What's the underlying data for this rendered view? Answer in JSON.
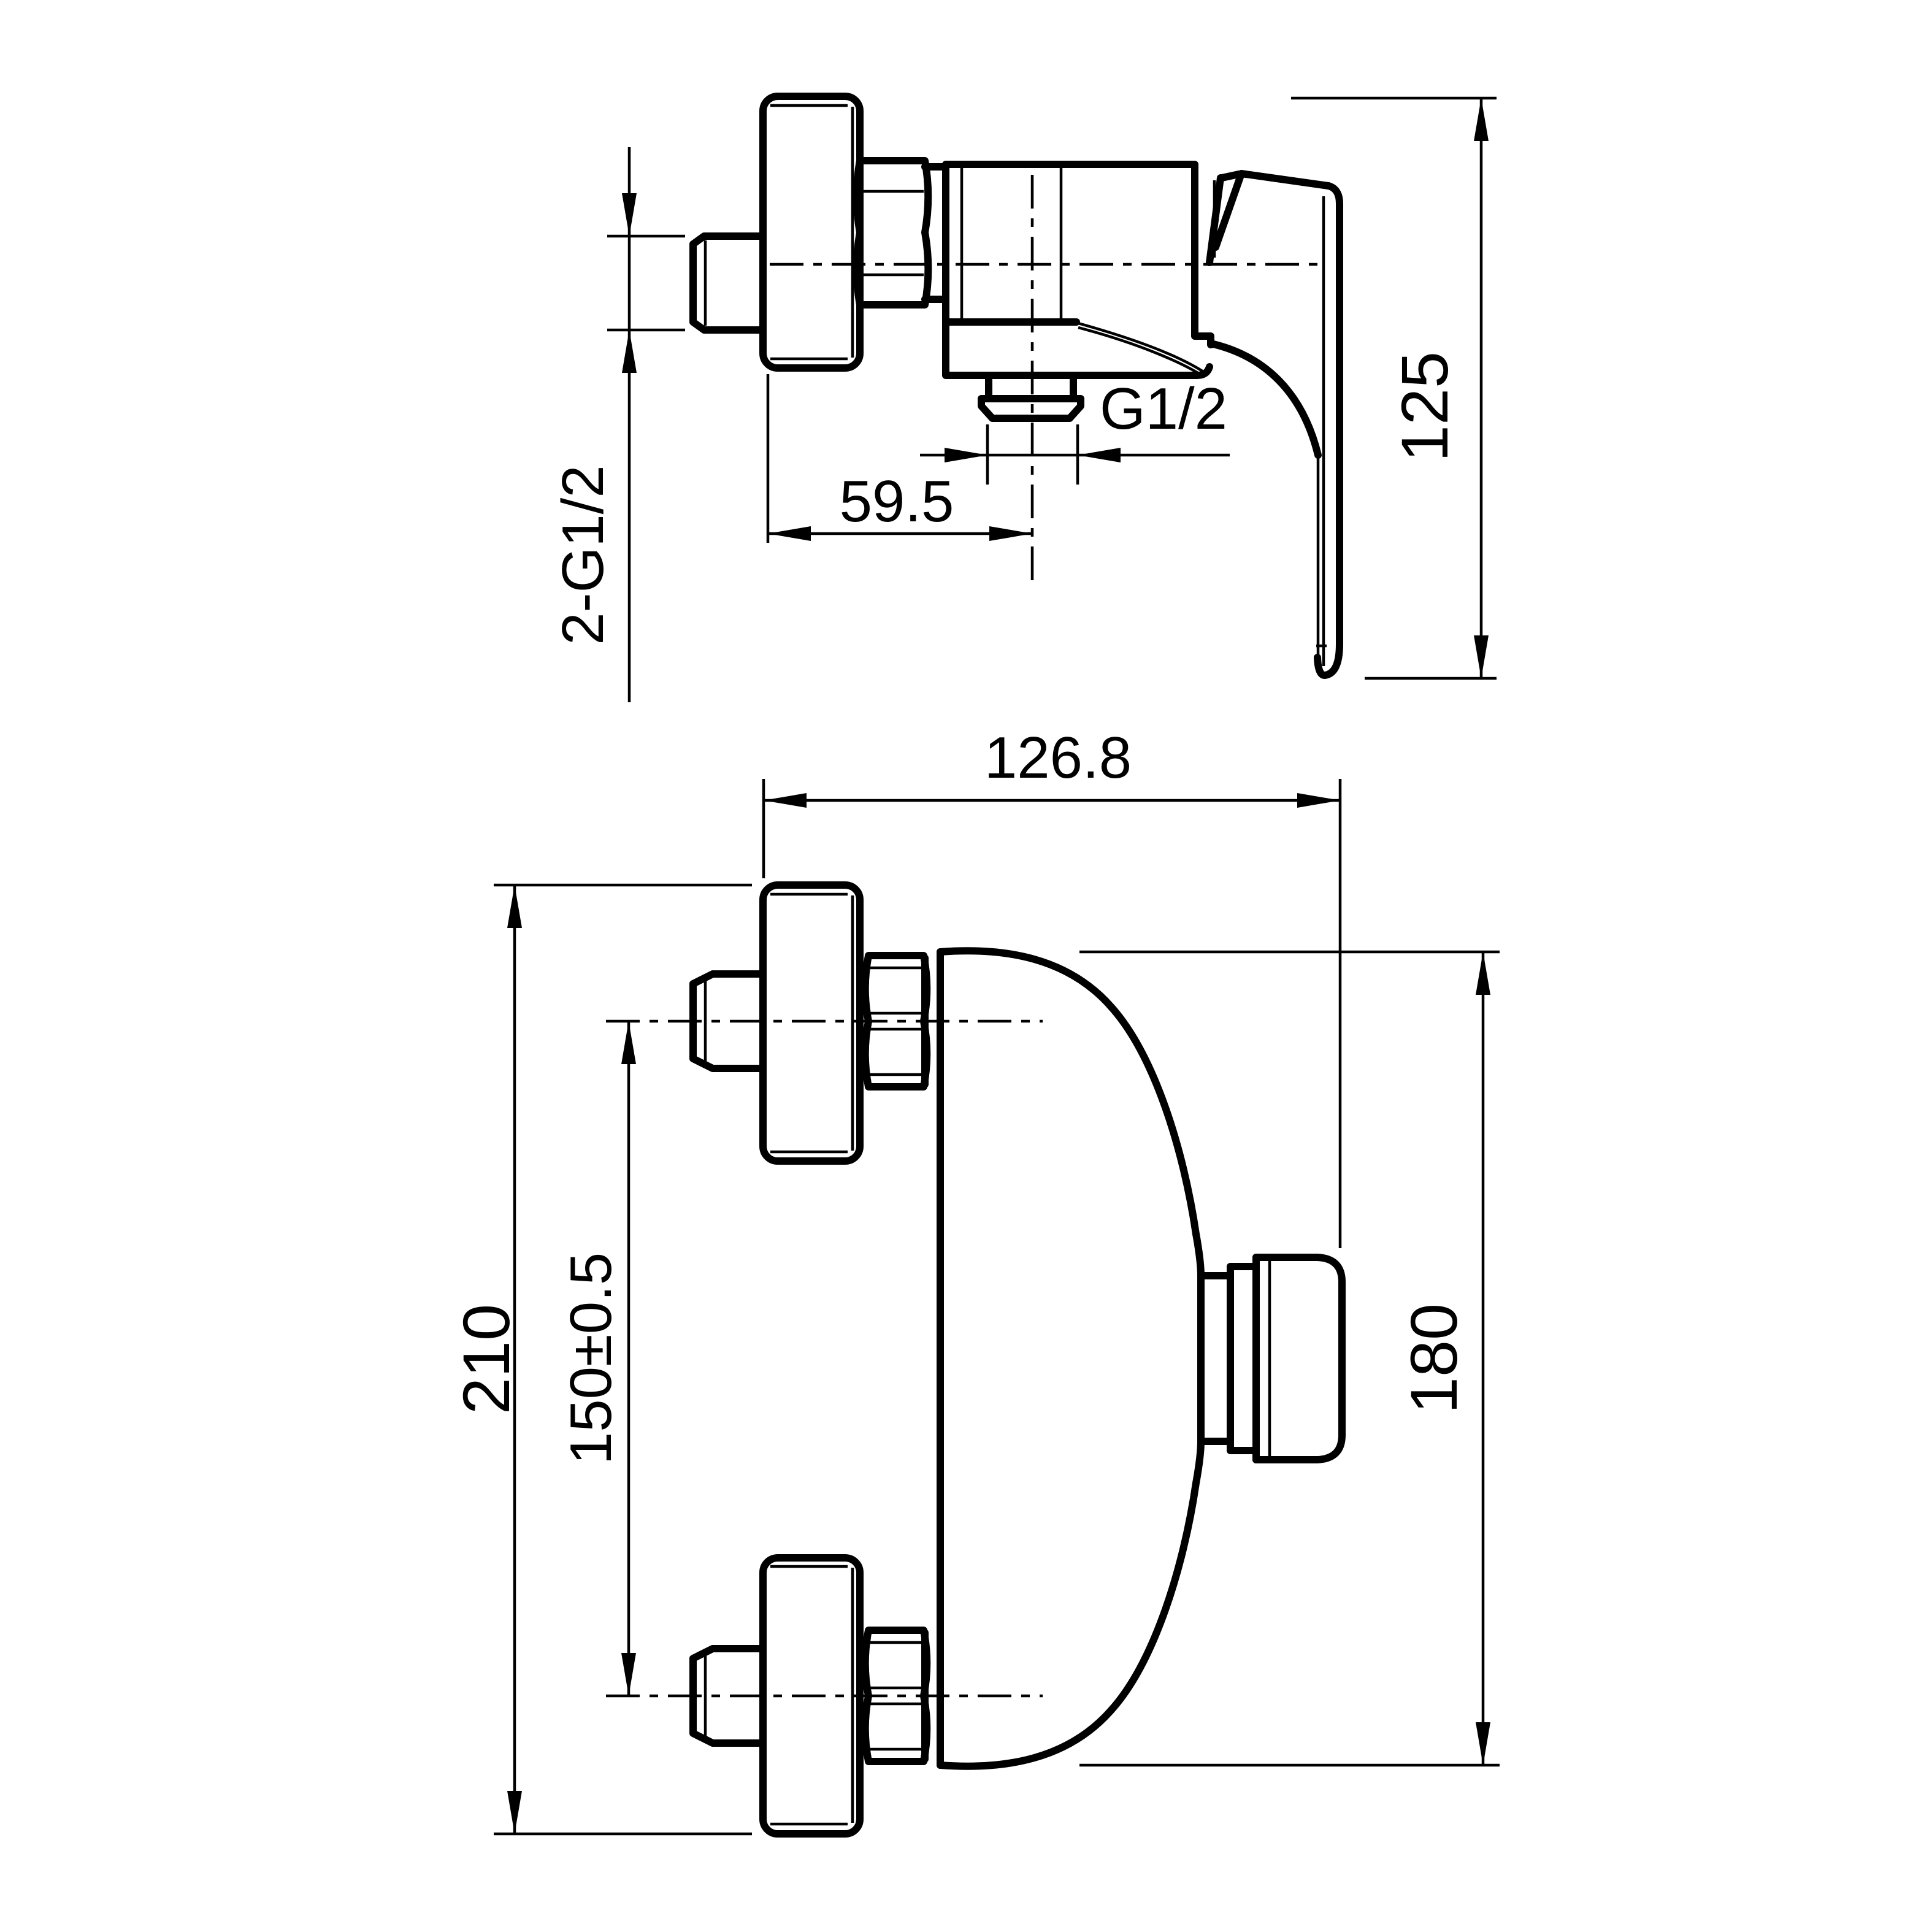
{
  "colors": {
    "ink": "#000000",
    "paper": "#ffffff"
  },
  "labels": {
    "wall_thread": "2-G1/2",
    "outlet_offset": "59.5",
    "outlet_thread": "G1/2",
    "side_height": "125",
    "front_width": "126.8",
    "overall_height": "210",
    "inlet_spacing": "150±0.5",
    "body_height": "180"
  }
}
